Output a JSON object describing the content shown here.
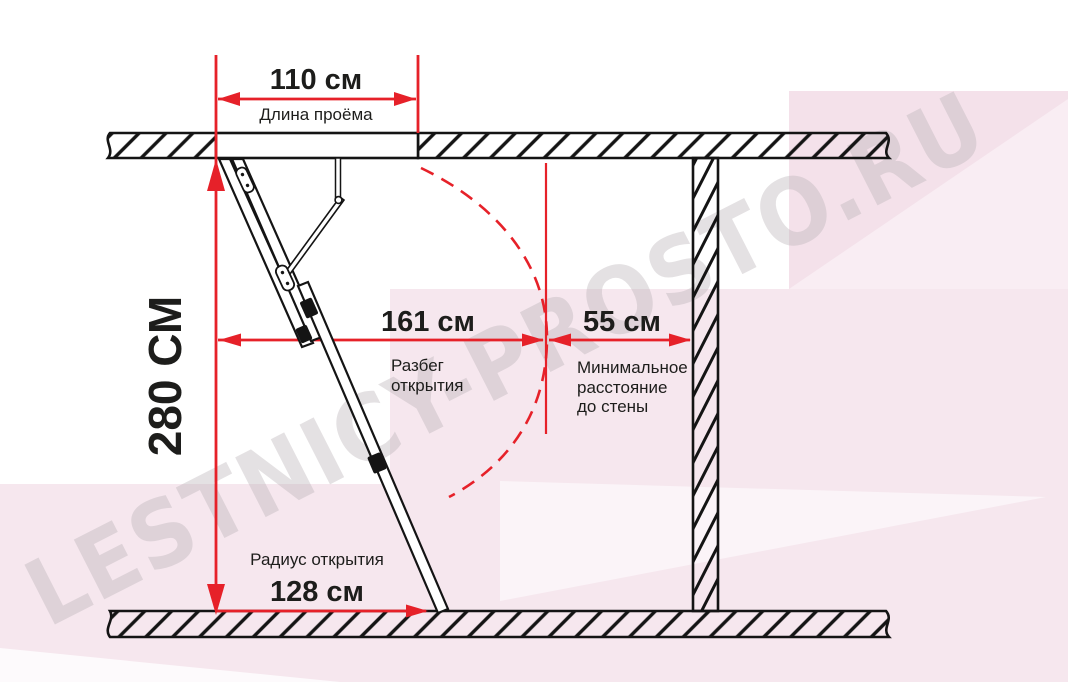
{
  "diagram": {
    "type": "attic-ladder-installation-dimensions",
    "watermark": {
      "text": "LESTNICY-PROSTO.RU"
    },
    "colors": {
      "dimension_red": "#e62129",
      "linework_black": "#141414",
      "text_black": "#1d1d1b",
      "background_pink": "#f6e7ee",
      "background_pink_dark": "#f4e1ea",
      "background_pink_light": "#f9edf3",
      "watermark_gray": "#e4e1e3"
    },
    "dimensions": {
      "opening_width": {
        "value": "110 см",
        "label": "Длина проёма"
      },
      "ceiling_height": {
        "value": "280 СМ"
      },
      "opening_span": {
        "value": "161 см",
        "label_line1": "Разбег",
        "label_line2": "открытия"
      },
      "wall_distance": {
        "value": "55 см",
        "label_line1": "Минимальное",
        "label_line2": "расстояние",
        "label_line3": "до стены"
      },
      "opening_radius": {
        "value": "128 см",
        "label": "Радиус открытия"
      }
    }
  }
}
